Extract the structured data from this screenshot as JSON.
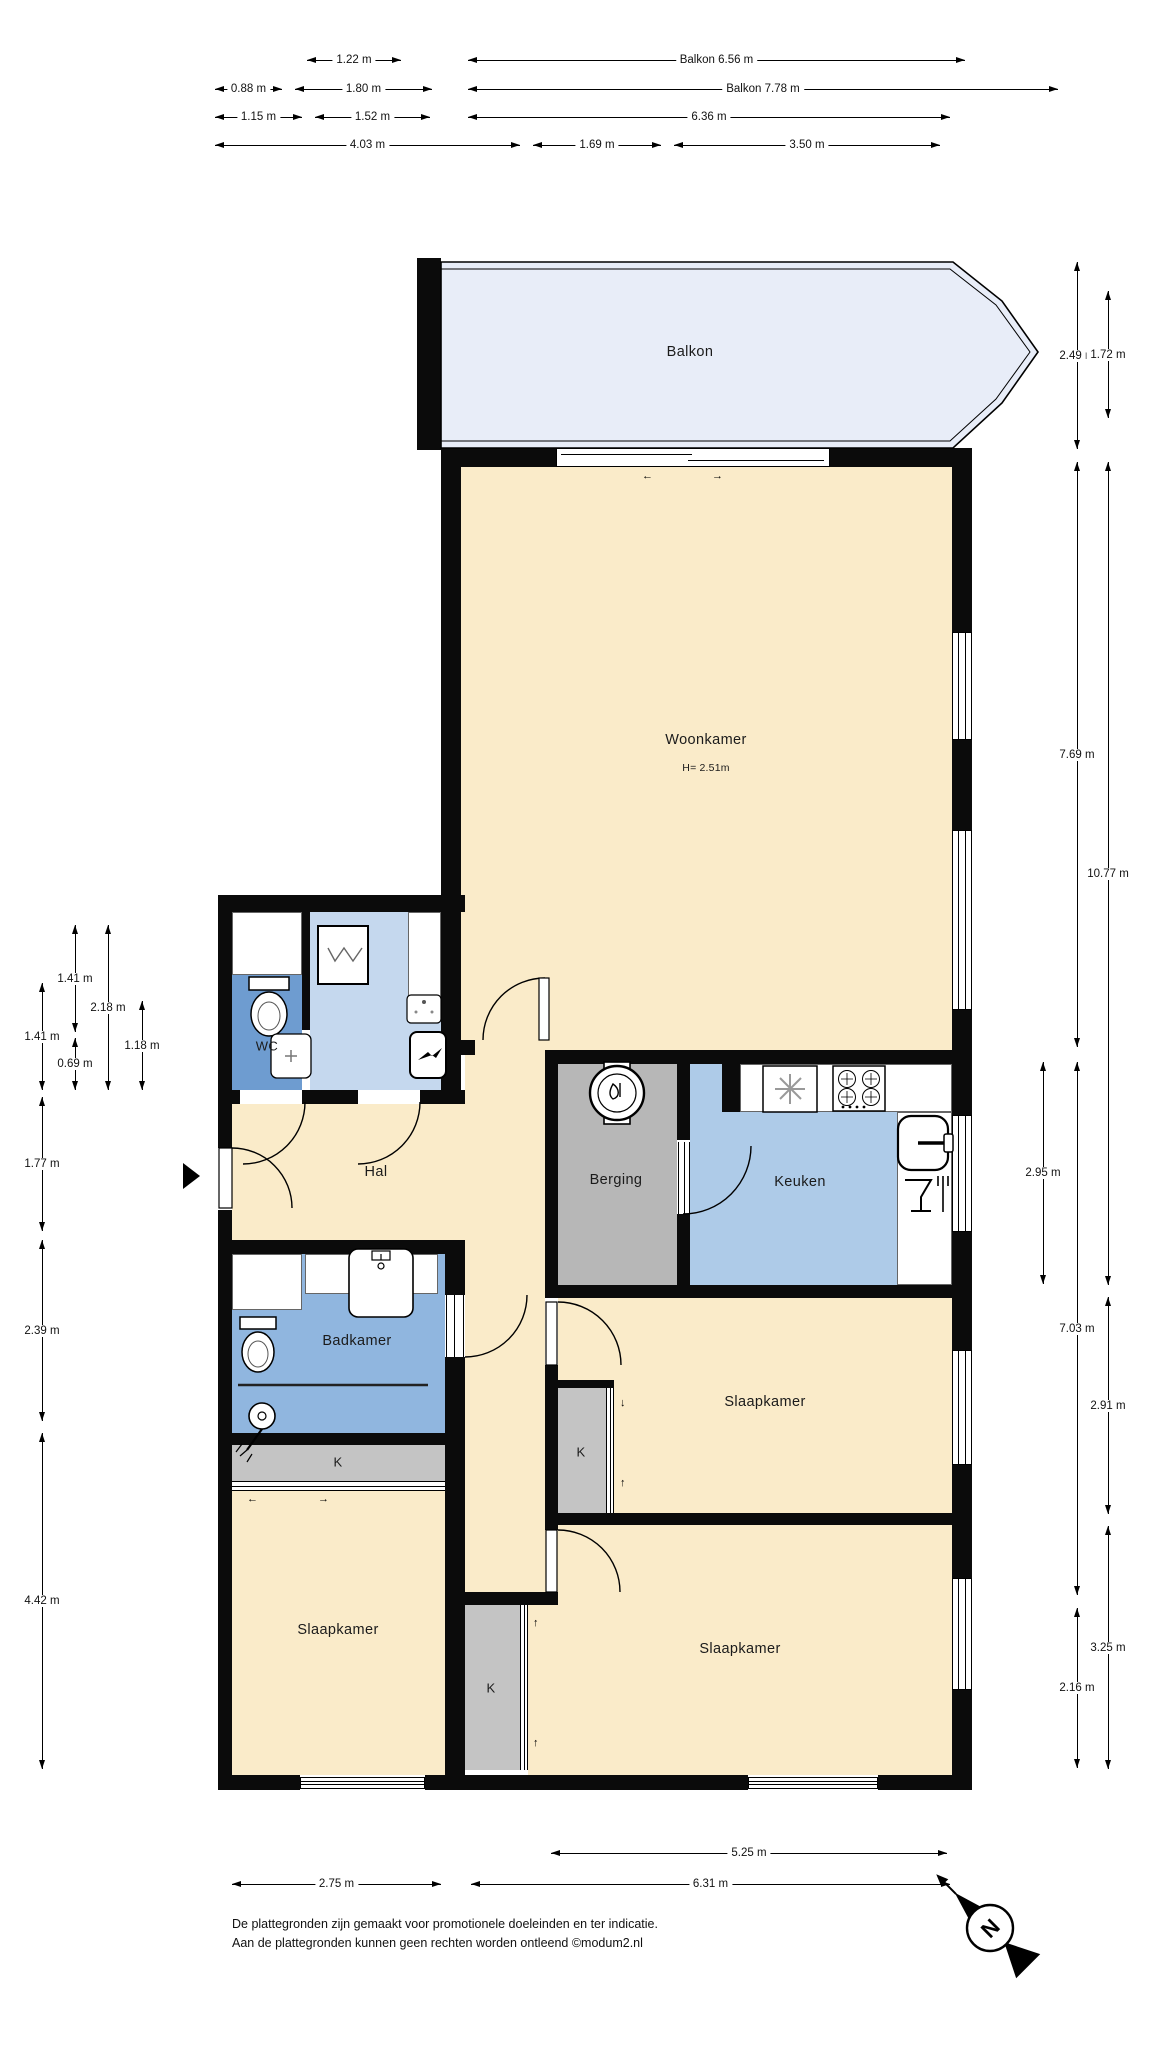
{
  "colors": {
    "wall": "#0b0b0b",
    "room_cream": "#FAEBC9",
    "balcony": "#E8EDF8",
    "kitchen_blue": "#AECBE8",
    "laundry_blue": "#C5D8EE",
    "bathroom_blue": "#90B6DF",
    "wc_blue": "#6E9CD0",
    "storage_gray": "#B7B7B7",
    "closet_gray": "#C4C4C4"
  },
  "rooms": {
    "balkon": "Balkon",
    "woonkamer": "Woonkamer",
    "woonkamer_height": "H= 2.51m",
    "wc": "WC",
    "hal": "Hal",
    "berging": "Berging",
    "keuken": "Keuken",
    "badkamer": "Badkamer",
    "closet": "K",
    "slaapkamer": "Slaapkamer"
  },
  "dimensions": [
    {
      "o": "h",
      "x": 307,
      "y": 60,
      "len": 94,
      "label": "1.22 m"
    },
    {
      "o": "h",
      "x": 468,
      "y": 60,
      "len": 497,
      "label": "Balkon 6.56 m"
    },
    {
      "o": "h",
      "x": 215,
      "y": 89,
      "len": 67,
      "label": "0.88 m"
    },
    {
      "o": "h",
      "x": 295,
      "y": 89,
      "len": 137,
      "label": "1.80 m"
    },
    {
      "o": "h",
      "x": 468,
      "y": 89,
      "len": 590,
      "label": "Balkon 7.78 m"
    },
    {
      "o": "h",
      "x": 215,
      "y": 117,
      "len": 87,
      "label": "1.15 m"
    },
    {
      "o": "h",
      "x": 315,
      "y": 117,
      "len": 115,
      "label": "1.52 m"
    },
    {
      "o": "h",
      "x": 468,
      "y": 117,
      "len": 482,
      "label": "6.36 m"
    },
    {
      "o": "h",
      "x": 215,
      "y": 145,
      "len": 305,
      "label": "4.03 m"
    },
    {
      "o": "h",
      "x": 533,
      "y": 145,
      "len": 128,
      "label": "1.69 m"
    },
    {
      "o": "h",
      "x": 674,
      "y": 145,
      "len": 266,
      "label": "3.50 m"
    },
    {
      "o": "v",
      "x": 75,
      "y": 925,
      "len": 107,
      "label": "1.41 m"
    },
    {
      "o": "v",
      "x": 108,
      "y": 925,
      "len": 165,
      "label": "2.18 m"
    },
    {
      "o": "v",
      "x": 42,
      "y": 983,
      "len": 107,
      "label": "1.41 m"
    },
    {
      "o": "v",
      "x": 75,
      "y": 1038,
      "len": 52,
      "label": "0.69 m"
    },
    {
      "o": "v",
      "x": 142,
      "y": 1001,
      "len": 89,
      "label": "1.18 m"
    },
    {
      "o": "v",
      "x": 42,
      "y": 1097,
      "len": 134,
      "label": "1.77 m"
    },
    {
      "o": "v",
      "x": 42,
      "y": 1240,
      "len": 181,
      "label": "2.39 m"
    },
    {
      "o": "v",
      "x": 42,
      "y": 1433,
      "len": 336,
      "label": "4.42 m"
    },
    {
      "o": "v",
      "x": 1077,
      "y": 262,
      "len": 187,
      "label": "2.49 m"
    },
    {
      "o": "v",
      "x": 1108,
      "y": 291,
      "len": 127,
      "label": "1.72 m"
    },
    {
      "o": "v",
      "x": 1077,
      "y": 462,
      "len": 585,
      "label": "7.69 m"
    },
    {
      "o": "v",
      "x": 1108,
      "y": 462,
      "len": 823,
      "label": "10.77 m"
    },
    {
      "o": "v",
      "x": 1043,
      "y": 1062,
      "len": 222,
      "label": "2.95 m"
    },
    {
      "o": "v",
      "x": 1077,
      "y": 1062,
      "len": 533,
      "label": "7.03 m"
    },
    {
      "o": "v",
      "x": 1108,
      "y": 1297,
      "len": 217,
      "label": "2.91 m"
    },
    {
      "o": "v",
      "x": 1108,
      "y": 1526,
      "len": 243,
      "label": "3.25 m"
    },
    {
      "o": "v",
      "x": 1077,
      "y": 1608,
      "len": 160,
      "label": "2.16 m"
    },
    {
      "o": "h",
      "x": 551,
      "y": 1853,
      "len": 396,
      "label": "5.25 m"
    },
    {
      "o": "h",
      "x": 232,
      "y": 1884,
      "len": 209,
      "label": "2.75 m"
    },
    {
      "o": "h",
      "x": 471,
      "y": 1884,
      "len": 479,
      "label": "6.31 m"
    }
  ],
  "compass": {
    "north": "N"
  },
  "footer": {
    "line1": "De plattegronden zijn gemaakt voor promotionele doeleinden en ter indicatie.",
    "line2": "Aan de plattegronden kunnen geen rechten worden ontleend ©modum2.nl"
  }
}
